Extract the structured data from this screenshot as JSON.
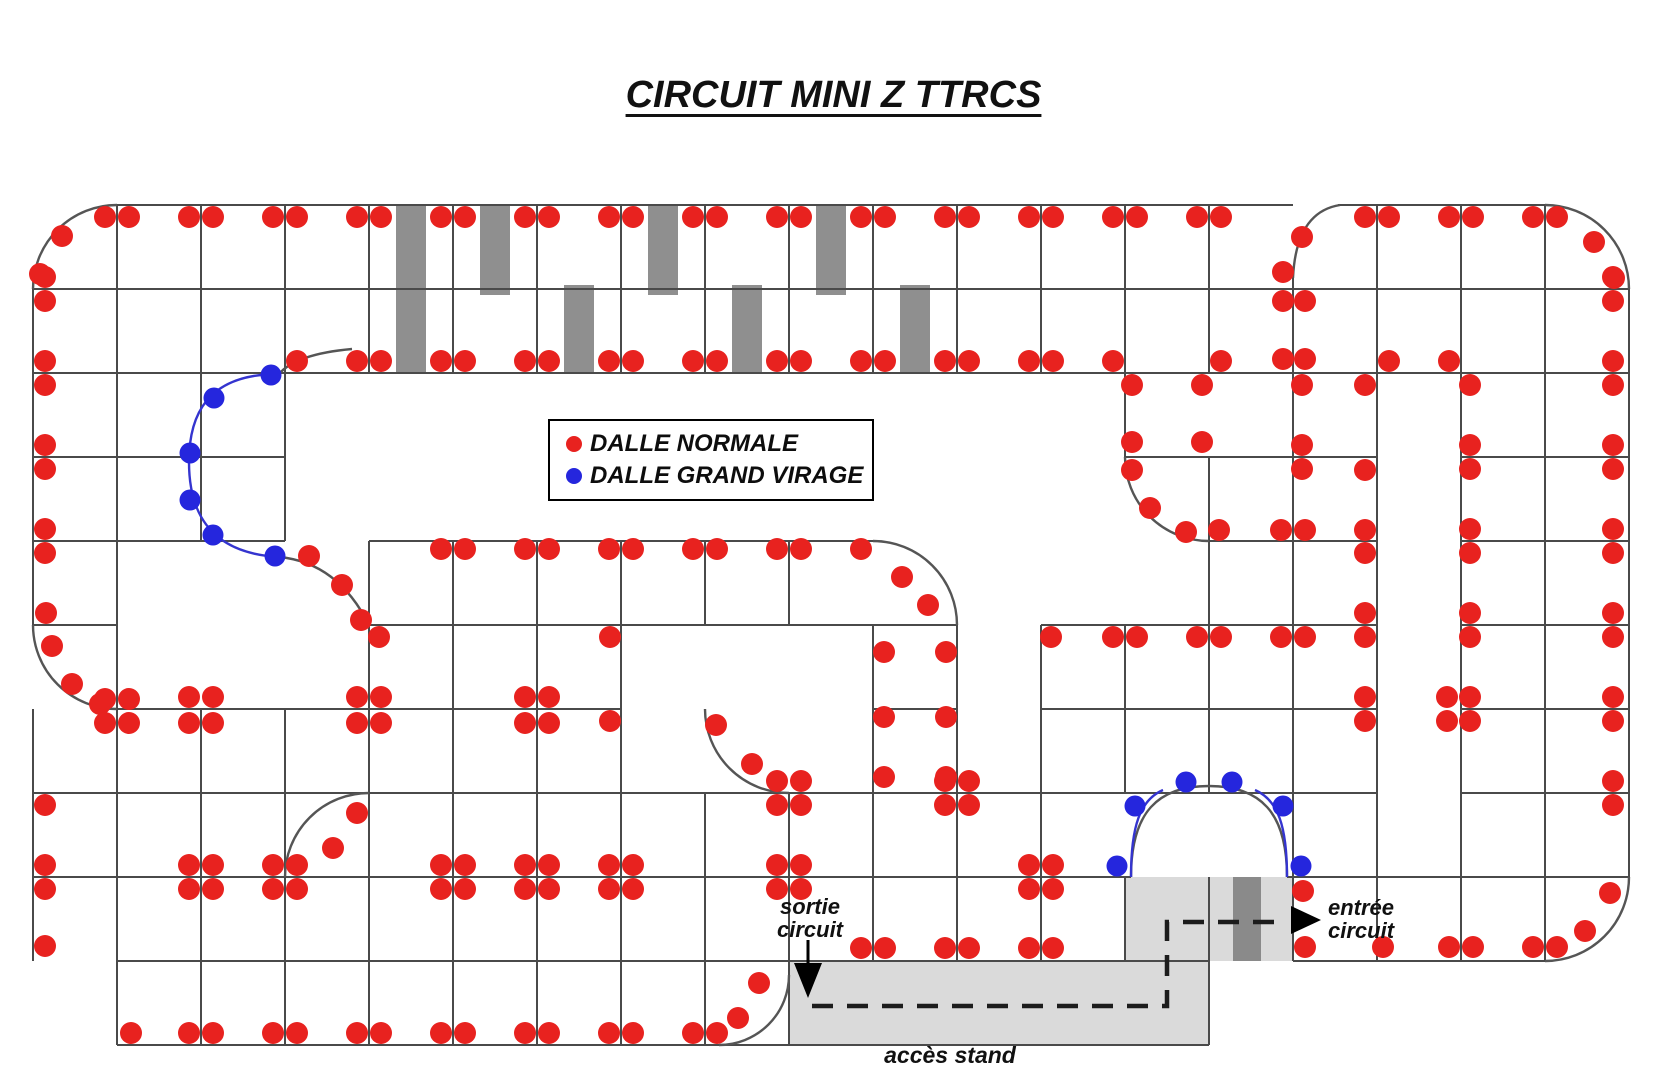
{
  "canvas": {
    "w": 1667,
    "h": 1080
  },
  "title": {
    "text": "CIRCUIT MINI Z TTRCS"
  },
  "legend": {
    "items": [
      {
        "label": "DALLE NORMALE",
        "color": "#e8221f"
      },
      {
        "label": "DALLE GRAND VIRAGE",
        "color": "#2526dd"
      }
    ]
  },
  "labels": {
    "sortie": {
      "line1": "sortie",
      "line2": "circuit"
    },
    "entree": {
      "line1": "entrée",
      "line2": "circuit"
    },
    "acces": {
      "text": "accès stand"
    }
  },
  "colors": {
    "dot_red": "#e8221f",
    "dot_blue": "#2526dd",
    "grid": "#4a4a4a",
    "arc": "#555555",
    "arc_blue": "#3434cf",
    "bar_gray": "#8f8f8f",
    "area_light": "#dadada",
    "area_dark": "#8a8a8a",
    "dash": "#1c1c1c",
    "arrow": "#000000"
  },
  "grid": {
    "h": [
      [
        205,
        117,
        1293
      ],
      [
        205,
        1338,
        1545
      ],
      [
        289,
        33,
        1629
      ],
      [
        373,
        33,
        1629
      ],
      [
        457,
        33,
        285
      ],
      [
        457,
        1125,
        1377
      ],
      [
        457,
        1461,
        1629
      ],
      [
        541,
        33,
        285
      ],
      [
        541,
        369,
        873
      ],
      [
        541,
        1209,
        1377
      ],
      [
        541,
        1461,
        1629
      ],
      [
        625,
        33,
        117
      ],
      [
        625,
        369,
        957
      ],
      [
        625,
        1041,
        1377
      ],
      [
        625,
        1461,
        1629
      ],
      [
        709,
        117,
        621
      ],
      [
        709,
        873,
        957
      ],
      [
        709,
        1041,
        1377
      ],
      [
        709,
        1461,
        1629
      ],
      [
        793,
        33,
        1377
      ],
      [
        793,
        1461,
        1629
      ],
      [
        877,
        33,
        1131
      ],
      [
        877,
        1287,
        1629
      ],
      [
        961,
        117,
        1209
      ],
      [
        961,
        1293,
        1545
      ],
      [
        1045,
        117,
        1209
      ]
    ],
    "v": [
      [
        33,
        289,
        625
      ],
      [
        33,
        709,
        961
      ],
      [
        117,
        205,
        1045
      ],
      [
        201,
        205,
        541
      ],
      [
        201,
        709,
        1045
      ],
      [
        285,
        205,
        541
      ],
      [
        285,
        709,
        1045
      ],
      [
        369,
        205,
        373
      ],
      [
        369,
        541,
        1045
      ],
      [
        453,
        205,
        373
      ],
      [
        453,
        541,
        1045
      ],
      [
        537,
        205,
        373
      ],
      [
        537,
        541,
        1045
      ],
      [
        621,
        205,
        373
      ],
      [
        621,
        541,
        1045
      ],
      [
        705,
        205,
        373
      ],
      [
        705,
        541,
        625
      ],
      [
        705,
        793,
        1045
      ],
      [
        789,
        205,
        373
      ],
      [
        789,
        541,
        625
      ],
      [
        789,
        793,
        1045
      ],
      [
        873,
        205,
        373
      ],
      [
        873,
        625,
        961
      ],
      [
        957,
        205,
        373
      ],
      [
        957,
        625,
        961
      ],
      [
        1041,
        205,
        373
      ],
      [
        1041,
        625,
        961
      ],
      [
        1125,
        205,
        457
      ],
      [
        1125,
        625,
        793
      ],
      [
        1125,
        877,
        961
      ],
      [
        1209,
        205,
        373
      ],
      [
        1209,
        457,
        793
      ],
      [
        1209,
        877,
        1045
      ],
      [
        1293,
        278,
        961
      ],
      [
        1377,
        205,
        961
      ],
      [
        1461,
        205,
        961
      ],
      [
        1545,
        205,
        961
      ],
      [
        1629,
        289,
        877
      ]
    ]
  },
  "arcs": [
    {
      "d": "M33,289 A84,84 0 0 1 117,205",
      "c": "arc"
    },
    {
      "d": "M1545,205 A84,84 0 0 1 1629,289",
      "c": "arc"
    },
    {
      "d": "M1293,278 Q1296,212 1340,205",
      "c": "arc"
    },
    {
      "d": "M352,349 Q296,354 279,374",
      "c": "arc"
    },
    {
      "d": "M279,374 C206,374 189,416 189,462 C189,508 206,553 279,557",
      "c": "arc_blue"
    },
    {
      "d": "M279,557 C322,561 350,587 369,625",
      "c": "arc"
    },
    {
      "d": "M33,625 A84,84 0 0 0 117,709",
      "c": "arc"
    },
    {
      "d": "M873,541 A84,84 0 0 1 957,625",
      "c": "arc"
    },
    {
      "d": "M285,877 A84,84 0 0 1 369,793",
      "c": "arc"
    },
    {
      "d": "M1125,457 A84,84 0 0 0 1209,541",
      "c": "arc"
    },
    {
      "d": "M705,709 A84,84 0 0 0 789,793",
      "c": "arc"
    },
    {
      "d": "M789,975 A70,70 0 0 1 719,1045",
      "c": "arc"
    },
    {
      "d": "M1629,877 A84,84 0 0 1 1545,961",
      "c": "arc"
    },
    {
      "d": "M1131,877 C1131,812 1158,786 1209,786 C1260,786 1287,812 1287,877",
      "c": "arc"
    },
    {
      "d": "M1131,877 C1131,826 1140,800 1163,790",
      "c": "arc_blue"
    },
    {
      "d": "M1287,877 C1287,826 1278,800 1255,790",
      "c": "arc_blue"
    }
  ],
  "bars": [
    [
      396,
      205,
      30,
      168
    ],
    [
      480,
      205,
      30,
      90
    ],
    [
      648,
      205,
      30,
      90
    ],
    [
      816,
      205,
      30,
      90
    ],
    [
      564,
      285,
      30,
      88
    ],
    [
      732,
      285,
      30,
      88
    ],
    [
      900,
      285,
      30,
      88
    ]
  ],
  "areas": [
    {
      "x": 789,
      "y": 961,
      "w": 420,
      "h": 84,
      "c": "area_light"
    },
    {
      "x": 1125,
      "y": 877,
      "w": 168,
      "h": 84,
      "c": "area_light"
    },
    {
      "x": 1233,
      "y": 877,
      "w": 28,
      "h": 84,
      "c": "area_dark"
    }
  ],
  "dashed": {
    "d": "M812,1006 H1167 V922 H1288"
  },
  "arrows": {
    "sortie_stem": [
      808,
      940,
      808,
      963
    ],
    "sortie_tri": "794,963 822,963 808,998",
    "entree_tri": "1291,906 1291,934 1321,920"
  },
  "dots": {
    "red": [
      [
        105,
        217
      ],
      [
        129,
        217
      ],
      [
        189,
        217
      ],
      [
        213,
        217
      ],
      [
        273,
        217
      ],
      [
        297,
        217
      ],
      [
        357,
        217
      ],
      [
        381,
        217
      ],
      [
        441,
        217
      ],
      [
        465,
        217
      ],
      [
        525,
        217
      ],
      [
        549,
        217
      ],
      [
        609,
        217
      ],
      [
        633,
        217
      ],
      [
        693,
        217
      ],
      [
        717,
        217
      ],
      [
        777,
        217
      ],
      [
        801,
        217
      ],
      [
        861,
        217
      ],
      [
        885,
        217
      ],
      [
        945,
        217
      ],
      [
        969,
        217
      ],
      [
        1029,
        217
      ],
      [
        1053,
        217
      ],
      [
        1113,
        217
      ],
      [
        1137,
        217
      ],
      [
        1197,
        217
      ],
      [
        1221,
        217
      ],
      [
        1365,
        217
      ],
      [
        1389,
        217
      ],
      [
        1449,
        217
      ],
      [
        1473,
        217
      ],
      [
        1533,
        217
      ],
      [
        1557,
        217
      ],
      [
        62,
        236
      ],
      [
        40,
        274
      ],
      [
        1594,
        242
      ],
      [
        1614,
        278
      ],
      [
        1302,
        237
      ],
      [
        1283,
        272
      ],
      [
        1283,
        301
      ],
      [
        1305,
        301
      ],
      [
        1283,
        359
      ],
      [
        1305,
        359
      ],
      [
        45,
        277
      ],
      [
        45,
        301
      ],
      [
        45,
        361
      ],
      [
        45,
        385
      ],
      [
        45,
        445
      ],
      [
        45,
        469
      ],
      [
        45,
        529
      ],
      [
        45,
        553
      ],
      [
        46,
        613
      ],
      [
        52,
        646
      ],
      [
        72,
        684
      ],
      [
        100,
        704
      ],
      [
        45,
        805
      ],
      [
        45,
        865
      ],
      [
        45,
        889
      ],
      [
        45,
        946
      ],
      [
        105,
        699
      ],
      [
        129,
        699
      ],
      [
        105,
        723
      ],
      [
        129,
        723
      ],
      [
        357,
        361
      ],
      [
        381,
        361
      ],
      [
        441,
        361
      ],
      [
        465,
        361
      ],
      [
        525,
        361
      ],
      [
        549,
        361
      ],
      [
        609,
        361
      ],
      [
        633,
        361
      ],
      [
        693,
        361
      ],
      [
        717,
        361
      ],
      [
        777,
        361
      ],
      [
        801,
        361
      ],
      [
        861,
        361
      ],
      [
        885,
        361
      ],
      [
        945,
        361
      ],
      [
        969,
        361
      ],
      [
        1029,
        361
      ],
      [
        1053,
        361
      ],
      [
        297,
        361
      ],
      [
        1113,
        361
      ],
      [
        1221,
        361
      ],
      [
        1389,
        361
      ],
      [
        1449,
        361
      ],
      [
        1132,
        385
      ],
      [
        1202,
        385
      ],
      [
        1132,
        442
      ],
      [
        1202,
        442
      ],
      [
        1132,
        470
      ],
      [
        1150,
        508
      ],
      [
        1186,
        532
      ],
      [
        1302,
        385
      ],
      [
        1302,
        445
      ],
      [
        1302,
        469
      ],
      [
        1365,
        385
      ],
      [
        1365,
        470
      ],
      [
        1365,
        553
      ],
      [
        1365,
        613
      ],
      [
        1365,
        697
      ],
      [
        1365,
        721
      ],
      [
        1219,
        530
      ],
      [
        1281,
        530
      ],
      [
        1305,
        530
      ],
      [
        1365,
        530
      ],
      [
        1051,
        637
      ],
      [
        1113,
        637
      ],
      [
        1137,
        637
      ],
      [
        1197,
        637
      ],
      [
        1221,
        637
      ],
      [
        1281,
        637
      ],
      [
        1305,
        637
      ],
      [
        1365,
        637
      ],
      [
        1470,
        385
      ],
      [
        1470,
        445
      ],
      [
        1470,
        469
      ],
      [
        1470,
        529
      ],
      [
        1470,
        553
      ],
      [
        1470,
        613
      ],
      [
        1470,
        637
      ],
      [
        1470,
        697
      ],
      [
        1470,
        721
      ],
      [
        1447,
        697
      ],
      [
        1447,
        721
      ],
      [
        1613,
        277
      ],
      [
        1613,
        301
      ],
      [
        1613,
        361
      ],
      [
        1613,
        385
      ],
      [
        1613,
        445
      ],
      [
        1613,
        469
      ],
      [
        1613,
        529
      ],
      [
        1613,
        553
      ],
      [
        1613,
        613
      ],
      [
        1613,
        637
      ],
      [
        1613,
        697
      ],
      [
        1613,
        721
      ],
      [
        1613,
        781
      ],
      [
        1613,
        805
      ],
      [
        1610,
        893
      ],
      [
        1585,
        931
      ],
      [
        1305,
        947
      ],
      [
        1383,
        947
      ],
      [
        1449,
        947
      ],
      [
        1473,
        947
      ],
      [
        1533,
        947
      ],
      [
        1557,
        947
      ],
      [
        1303,
        891
      ],
      [
        441,
        549
      ],
      [
        465,
        549
      ],
      [
        525,
        549
      ],
      [
        549,
        549
      ],
      [
        609,
        549
      ],
      [
        633,
        549
      ],
      [
        693,
        549
      ],
      [
        717,
        549
      ],
      [
        777,
        549
      ],
      [
        801,
        549
      ],
      [
        861,
        549
      ],
      [
        902,
        577
      ],
      [
        928,
        605
      ],
      [
        309,
        556
      ],
      [
        342,
        585
      ],
      [
        361,
        620
      ],
      [
        884,
        652
      ],
      [
        884,
        717
      ],
      [
        884,
        777
      ],
      [
        946,
        652
      ],
      [
        946,
        717
      ],
      [
        946,
        777
      ],
      [
        716,
        725
      ],
      [
        752,
        764
      ],
      [
        189,
        697
      ],
      [
        213,
        697
      ],
      [
        189,
        723
      ],
      [
        213,
        723
      ],
      [
        357,
        697
      ],
      [
        381,
        697
      ],
      [
        357,
        723
      ],
      [
        381,
        723
      ],
      [
        525,
        697
      ],
      [
        549,
        697
      ],
      [
        525,
        723
      ],
      [
        549,
        723
      ],
      [
        379,
        637
      ],
      [
        610,
        637
      ],
      [
        610,
        721
      ],
      [
        189,
        865
      ],
      [
        213,
        865
      ],
      [
        189,
        889
      ],
      [
        213,
        889
      ],
      [
        273,
        865
      ],
      [
        297,
        865
      ],
      [
        273,
        889
      ],
      [
        297,
        889
      ],
      [
        441,
        865
      ],
      [
        465,
        865
      ],
      [
        441,
        889
      ],
      [
        465,
        889
      ],
      [
        525,
        865
      ],
      [
        549,
        865
      ],
      [
        525,
        889
      ],
      [
        549,
        889
      ],
      [
        609,
        865
      ],
      [
        633,
        865
      ],
      [
        609,
        889
      ],
      [
        633,
        889
      ],
      [
        777,
        865
      ],
      [
        801,
        865
      ],
      [
        777,
        889
      ],
      [
        801,
        889
      ],
      [
        333,
        848
      ],
      [
        357,
        813
      ],
      [
        777,
        781
      ],
      [
        801,
        781
      ],
      [
        777,
        805
      ],
      [
        801,
        805
      ],
      [
        945,
        781
      ],
      [
        969,
        781
      ],
      [
        945,
        805
      ],
      [
        969,
        805
      ],
      [
        1029,
        865
      ],
      [
        1053,
        865
      ],
      [
        1029,
        889
      ],
      [
        1053,
        889
      ],
      [
        861,
        948
      ],
      [
        885,
        948
      ],
      [
        945,
        948
      ],
      [
        969,
        948
      ],
      [
        1029,
        948
      ],
      [
        1053,
        948
      ],
      [
        131,
        1033
      ],
      [
        189,
        1033
      ],
      [
        213,
        1033
      ],
      [
        273,
        1033
      ],
      [
        297,
        1033
      ],
      [
        357,
        1033
      ],
      [
        381,
        1033
      ],
      [
        441,
        1033
      ],
      [
        465,
        1033
      ],
      [
        525,
        1033
      ],
      [
        549,
        1033
      ],
      [
        609,
        1033
      ],
      [
        633,
        1033
      ],
      [
        693,
        1033
      ],
      [
        717,
        1033
      ],
      [
        738,
        1018
      ],
      [
        759,
        983
      ]
    ],
    "blue": [
      [
        271,
        375
      ],
      [
        214,
        398
      ],
      [
        190,
        453
      ],
      [
        190,
        500
      ],
      [
        213,
        535
      ],
      [
        275,
        556
      ],
      [
        1117,
        866
      ],
      [
        1135,
        806
      ],
      [
        1186,
        782
      ],
      [
        1232,
        782
      ],
      [
        1283,
        806
      ],
      [
        1301,
        866
      ]
    ]
  }
}
